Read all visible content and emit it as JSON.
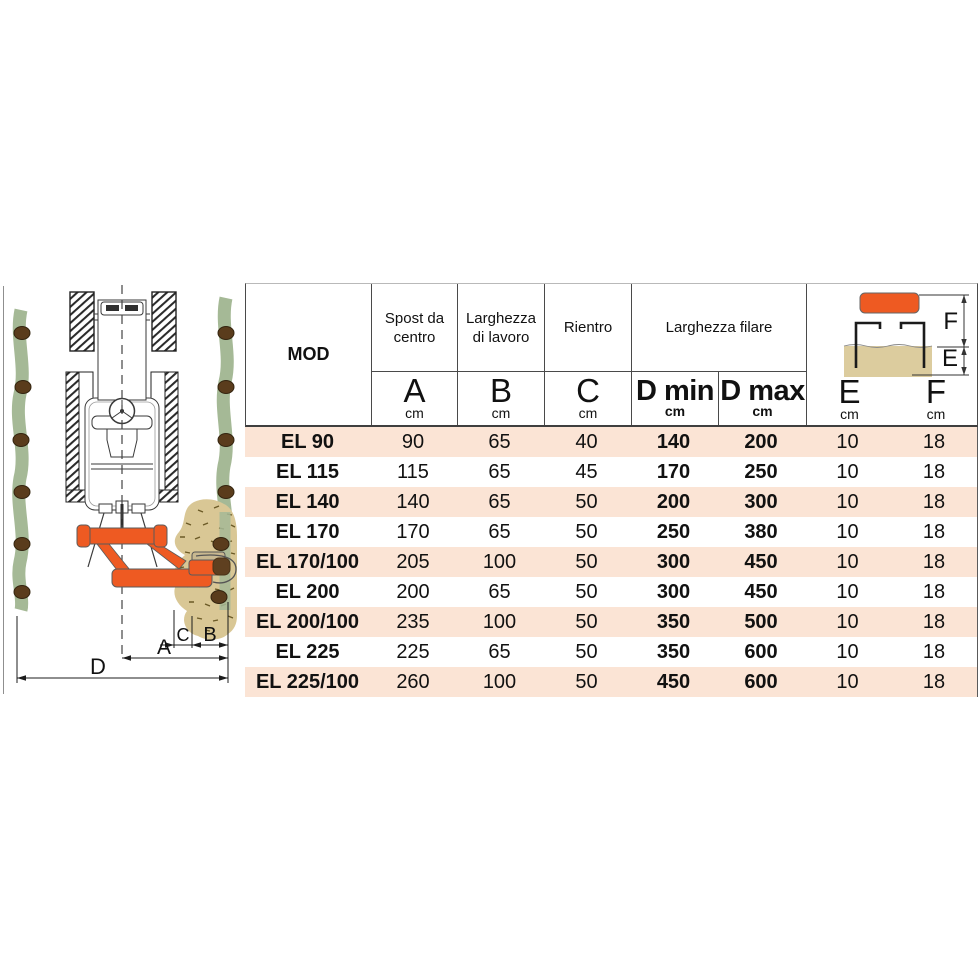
{
  "colors": {
    "accent_orange": "#EE5A22",
    "row_stripe_pink": "#FBE4D5",
    "soil_tan": "#D9C795",
    "plant_row_green": "#A5B996",
    "trunk_brown": "#5A3C1C"
  },
  "table": {
    "header": {
      "mod": "MOD",
      "col_groups": [
        {
          "label": "Spost da centro"
        },
        {
          "label": "Larghezza di lavoro"
        },
        {
          "label": "Rientro"
        },
        {
          "label": "Larghezza filare"
        }
      ],
      "sub_cols": [
        {
          "letter": "A",
          "unit": "cm"
        },
        {
          "letter": "B",
          "unit": "cm"
        },
        {
          "letter": "C",
          "unit": "cm"
        },
        {
          "letter": "D min",
          "unit": "cm"
        },
        {
          "letter": "D max",
          "unit": "cm"
        },
        {
          "letter": "E",
          "unit": "cm"
        },
        {
          "letter": "F",
          "unit": "cm"
        }
      ]
    },
    "rows": [
      {
        "model": "EL 90",
        "a": "90",
        "b": "65",
        "c": "40",
        "dmin": "140",
        "dmax": "200",
        "e": "10",
        "f": "18"
      },
      {
        "model": "EL 115",
        "a": "115",
        "b": "65",
        "c": "45",
        "dmin": "170",
        "dmax": "250",
        "e": "10",
        "f": "18"
      },
      {
        "model": "EL 140",
        "a": "140",
        "b": "65",
        "c": "50",
        "dmin": "200",
        "dmax": "300",
        "e": "10",
        "f": "18"
      },
      {
        "model": "EL 170",
        "a": "170",
        "b": "65",
        "c": "50",
        "dmin": "250",
        "dmax": "380",
        "e": "10",
        "f": "18"
      },
      {
        "model": "EL 170/100",
        "a": "205",
        "b": "100",
        "c": "50",
        "dmin": "300",
        "dmax": "450",
        "e": "10",
        "f": "18"
      },
      {
        "model": "EL 200",
        "a": "200",
        "b": "65",
        "c": "50",
        "dmin": "300",
        "dmax": "450",
        "e": "10",
        "f": "18"
      },
      {
        "model": "EL 200/100",
        "a": "235",
        "b": "100",
        "c": "50",
        "dmin": "350",
        "dmax": "500",
        "e": "10",
        "f": "18"
      },
      {
        "model": "EL 225",
        "a": "225",
        "b": "65",
        "c": "50",
        "dmin": "350",
        "dmax": "600",
        "e": "10",
        "f": "18"
      },
      {
        "model": "EL 225/100",
        "a": "260",
        "b": "100",
        "c": "50",
        "dmin": "450",
        "dmax": "600",
        "e": "10",
        "f": "18"
      }
    ]
  },
  "header_diagram": {
    "f_label": "F",
    "e_label": "E"
  },
  "field_diagram": {
    "dim_a": "A",
    "dim_b": "B",
    "dim_c": "C",
    "dim_d": "D"
  }
}
